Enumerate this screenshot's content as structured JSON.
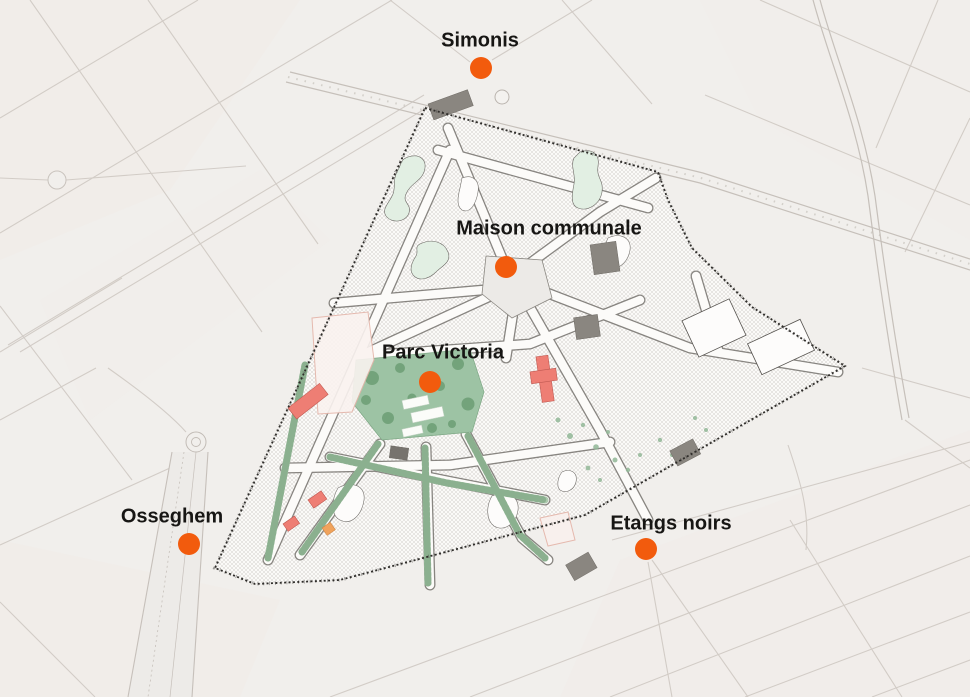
{
  "map": {
    "colors": {
      "marker": "#f25b0d",
      "label": "#171614",
      "background": "#f1efec",
      "study_area_fill": "#fbfaf8",
      "boundary": "#2f2d2a",
      "park_green": "#9dc3a4",
      "tree_green": "#6fa077",
      "courtyard_green": "#e2efe3",
      "corridor_green": "#adc9ae",
      "building_red": "#ee7e74",
      "building_orange": "#f0a35c",
      "building_gray": "#8a8680",
      "outside_street": "#cfc9c3"
    },
    "markers": [
      {
        "id": "simonis",
        "label": "Simonis",
        "dot_x": 481,
        "dot_y": 68,
        "label_x": 480,
        "label_y": 41
      },
      {
        "id": "maison-communale",
        "label": "Maison communale",
        "dot_x": 506,
        "dot_y": 267,
        "label_x": 549,
        "label_y": 229
      },
      {
        "id": "parc-victoria",
        "label": "Parc Victoria",
        "dot_x": 430,
        "dot_y": 382,
        "label_x": 443,
        "label_y": 353
      },
      {
        "id": "osseghem",
        "label": "Osseghem",
        "dot_x": 189,
        "dot_y": 544,
        "label_x": 172,
        "label_y": 517
      },
      {
        "id": "etangs-noirs",
        "label": "Etangs noirs",
        "dot_x": 646,
        "dot_y": 549,
        "label_x": 671,
        "label_y": 524
      }
    ]
  }
}
